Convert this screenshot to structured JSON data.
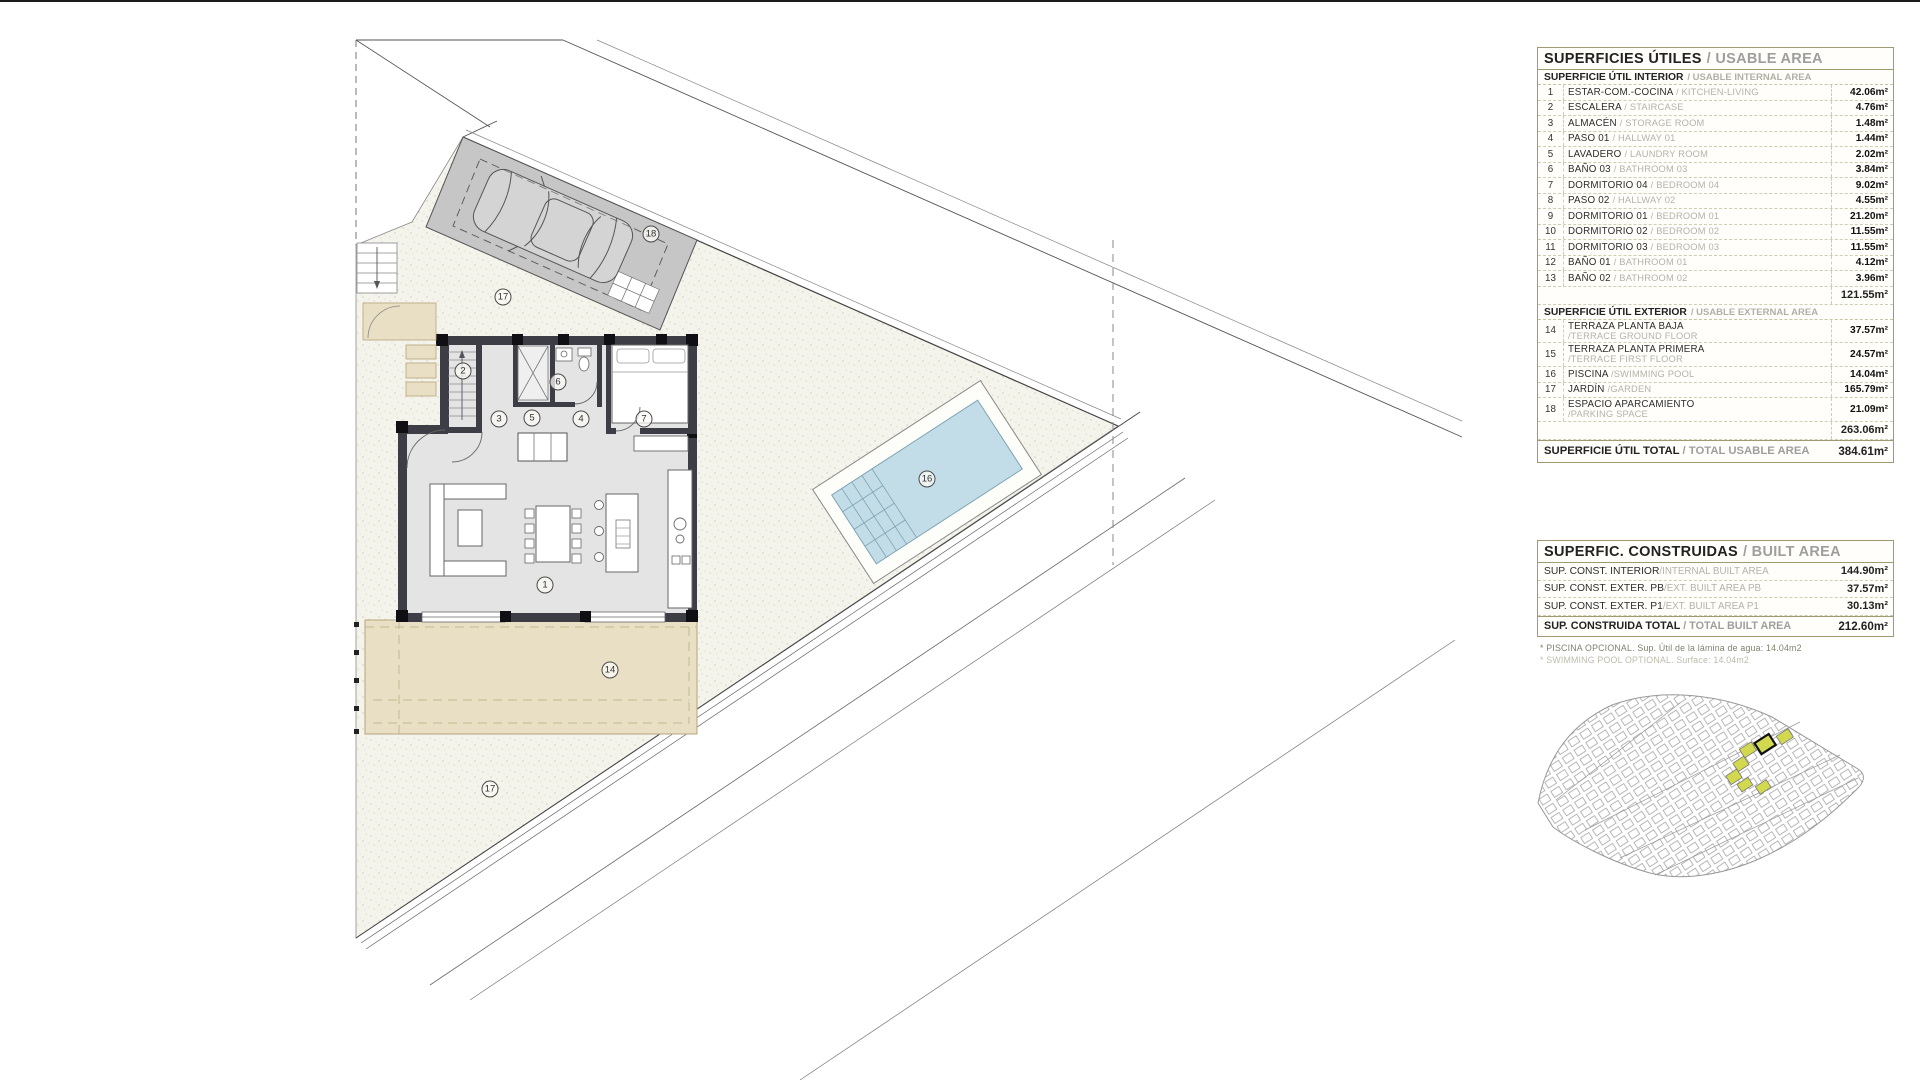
{
  "plan": {
    "area_labels": [
      {
        "n": "1",
        "x": 545,
        "y": 585
      },
      {
        "n": "2",
        "x": 463,
        "y": 371
      },
      {
        "n": "3",
        "x": 499,
        "y": 419
      },
      {
        "n": "5",
        "x": 532,
        "y": 418
      },
      {
        "n": "6",
        "x": 558,
        "y": 382
      },
      {
        "n": "4",
        "x": 581,
        "y": 419
      },
      {
        "n": "7",
        "x": 644,
        "y": 419
      },
      {
        "n": "14",
        "x": 610,
        "y": 670
      },
      {
        "n": "16",
        "x": 927,
        "y": 479
      },
      {
        "n": "17",
        "x": 503,
        "y": 297
      },
      {
        "n": "17",
        "x": 490,
        "y": 789
      },
      {
        "n": "18",
        "x": 651,
        "y": 234
      }
    ],
    "colors": {
      "garden": "#f5f4ec",
      "terrace": "#e9dfc4",
      "parking": "#c6c6c6",
      "pool": "#c2dde8",
      "walls": "#3d3d45",
      "interior": "#e4e4e4",
      "highlight": "#d3d94f"
    }
  },
  "usable_table": {
    "title_es": "SUPERFICIES ÚTILES",
    "title_en": "/ USABLE AREA",
    "interior_header_es": "SUPERFICIE ÚTIL INTERIOR",
    "interior_header_en": "/ USABLE INTERNAL AREA",
    "interior_rows": [
      {
        "num": "1",
        "es": "ESTAR-COM.-COCINA",
        "en": "/ KITCHEN-LIVING",
        "cls": "",
        "value": "42.06m²"
      },
      {
        "num": "2",
        "es": "ESCALERA",
        "en": "/ STAIRCASE",
        "cls": "",
        "value": "4.76m²"
      },
      {
        "num": "3",
        "es": "ALMACÉN",
        "en": "/ STORAGE ROOM",
        "cls": "",
        "value": "1.48m²"
      },
      {
        "num": "4",
        "es": "PASO 01",
        "en": "/ HALLWAY 01",
        "cls": "",
        "value": "1.44m²"
      },
      {
        "num": "5",
        "es": "LAVADERO",
        "en": "/ LAUNDRY ROOM",
        "cls": "",
        "value": "2.02m²"
      },
      {
        "num": "6",
        "es": "BAÑO 03",
        "en": "/ BATHROOM 03",
        "cls": "",
        "value": "3.84m²"
      },
      {
        "num": "7",
        "es": "DORMITORIO 04",
        "en": "/ BEDROOM 04",
        "cls": "",
        "value": "9.02m²"
      },
      {
        "num": "8",
        "es": "PASO 02",
        "en": "/ HALLWAY 02",
        "cls": "",
        "value": "4.55m²"
      },
      {
        "num": "9",
        "es": "DORMITORIO 01",
        "en": "/ BEDROOM 01",
        "cls": "",
        "value": "21.20m²"
      },
      {
        "num": "10",
        "es": "DORMITORIO 02",
        "en": "/ BEDROOM 02",
        "cls": "",
        "value": "11.55m²"
      },
      {
        "num": "11",
        "es": "DORMITORIO 03",
        "en": "/ BEDROOM 03",
        "cls": "",
        "value": "11.55m²"
      },
      {
        "num": "12",
        "es": "BAÑO 01",
        "en": "/ BATHROOM 01",
        "cls": "",
        "value": "4.12m²"
      },
      {
        "num": "13",
        "es": "BAÑO 02",
        "en": "/ BATHROOM 02",
        "cls": "",
        "value": "3.96m²"
      }
    ],
    "interior_subtotal": "121.55m²",
    "exterior_header_es": "SUPERFICIE ÚTIL EXTERIOR",
    "exterior_header_en": "/ USABLE EXTERNAL AREA",
    "exterior_rows": [
      {
        "num": "14",
        "es": "TERRAZA PLANTA BAJA",
        "en": "/TERRACE GROUND FLOOR",
        "cls": "stacked",
        "value": "37.57m²"
      },
      {
        "num": "15",
        "es": "TERRAZA PLANTA PRIMERA",
        "en": "/TERRACE FIRST FLOOR",
        "cls": "stacked",
        "value": "24.57m²"
      },
      {
        "num": "16",
        "es": "PISCINA",
        "en": "/SWIMMING POOL",
        "cls": "",
        "value": "14.04m²"
      },
      {
        "num": "17",
        "es": "JARDÍN",
        "en": "/GARDEN",
        "cls": "",
        "value": "165.79m²"
      },
      {
        "num": "18",
        "es": "ESPACIO APARCAMIENTO",
        "en": "/PARKING SPACE",
        "cls": "stacked",
        "value": "21.09m²"
      }
    ],
    "exterior_subtotal": "263.06m²",
    "total_es": "SUPERFICIE ÚTIL TOTAL",
    "total_en": "/ TOTAL USABLE AREA",
    "total_value": "384.61m²"
  },
  "built_table": {
    "title_es": "SUPERFIC. CONSTRUIDAS",
    "title_en": "/ BUILT AREA",
    "rows": [
      {
        "es": "SUP. CONST. INTERIOR",
        "en": "/INTERNAL BUILT AREA",
        "value": "144.90m²"
      },
      {
        "es": "SUP. CONST. EXTER. PB",
        "en": "/EXT. BUILT AREA PB",
        "value": "37.57m²"
      },
      {
        "es": "SUP. CONST. EXTER. P1",
        "en": "/EXT. BUILT AREA P1",
        "value": "30.13m²"
      }
    ],
    "total_es": "SUP. CONSTRUIDA TOTAL",
    "total_en": "/ TOTAL BUILT AREA",
    "total_value": "212.60m²"
  },
  "footnotes": {
    "line1": "* PISCINA OPCIONAL. Sup. Útil de la lámina de agua: 14.04m2",
    "line2": "* SWIMMING POOL OPTIONAL. Surface: 14.04m2"
  }
}
